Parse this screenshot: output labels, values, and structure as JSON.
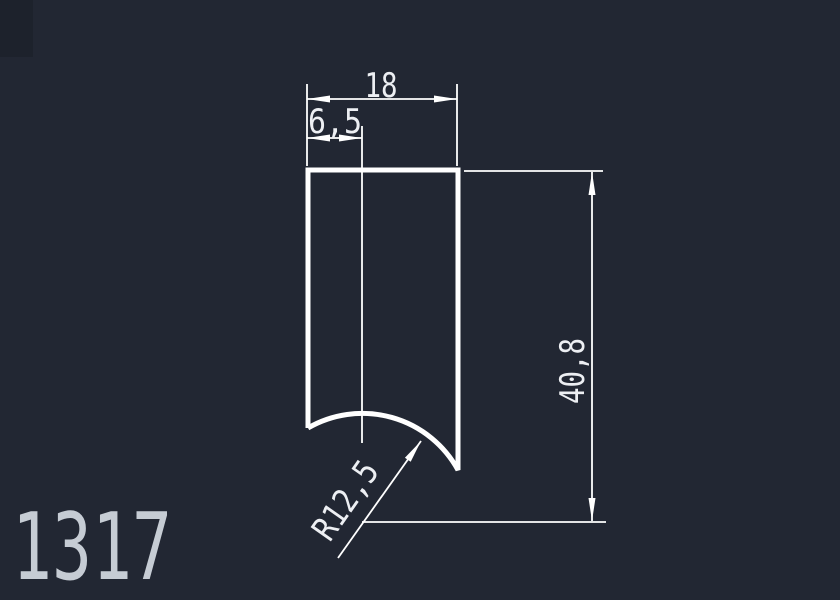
{
  "colors": {
    "background": "#222733",
    "corner_shade": "#1d222c",
    "line": "#ffffff",
    "dim_text": "#edeff3",
    "part_label": "#c6ccd4"
  },
  "drawing": {
    "part_number": "1317",
    "dimensions": {
      "total_width": "18",
      "offset_width": "6,5",
      "total_height": "40,8",
      "radius": "R12,5"
    }
  }
}
